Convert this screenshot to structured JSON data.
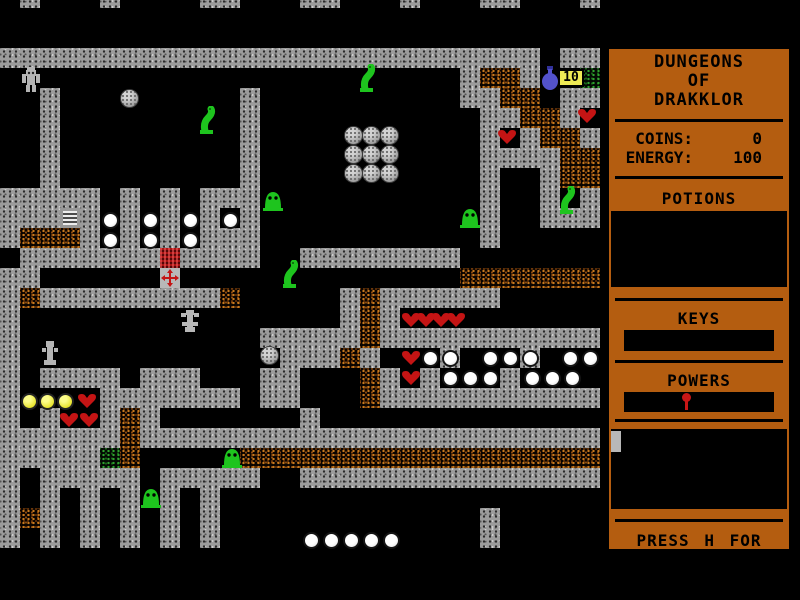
{
  "game": {
    "title_lines": [
      "DUNGEONS",
      "OF",
      "DRAKKLOR"
    ],
    "stats": [
      {
        "label": "COINS:",
        "value": "0"
      },
      {
        "label": "ENERGY:",
        "value": "100"
      }
    ],
    "sections": {
      "potions_label": "POTIONS",
      "keys_label": "KEYS",
      "powers_label": "POWERS"
    },
    "help_text": "PRESS H FOR HELP",
    "colors": {
      "panel_orange": "#b45d10",
      "wall_gray": "#9c9c9c",
      "rubble_orange": "#c87a1e",
      "moss_green": "#2fa32f",
      "heart_red": "#c41414",
      "creature_green": "#1ec41e",
      "flask_blue": "#5352cc",
      "badge_yellow": "#eeea55",
      "power_pin_red": "#c81616"
    }
  },
  "map": {
    "tile_size": 20,
    "offset_y": -12,
    "cols": 30,
    "rows": 31,
    "legend": {
      "#": "wall",
      ".": "floor",
      "r": "rubble",
      "g": "moss"
    },
    "grid": [
      ".#...#....##...##...#...##...#",
      "..............................",
      "..............................",
      "###########################.##",
      ".......................#rr#..g",
      "..#.........#..........##rr.##",
      "..#.........#...........##rr#.",
      "..#.........#...........#.#rr#",
      "..#.........#...........####rr",
      "..#.........#...........#..#rr",
      "#####.#.#.###...........#..#.#",
      "###.#.#.#.#.#...........#..###",
      "#rrr#.#.#.###...........#.....",
      ".#######.####..########.......",
      "##.....................rrrrrrr",
      "#r#########r.....#r######.....",
      "#................#r#..........",
      "#............#####r###########",
      "#.............###r#...#...#..",
      "#.####.###...##...r#.#...#....",
      "#....#######.##...r###########",
      "#.#..#r#.......#..............",
      "######r#######################",
      "#####gr.....rrrrrrrrrrrrrrrrrr",
      "#.#####.#####..###############",
      "#.#.#.#.#.#...................",
      "#r#.#.#.#.#.............#.....",
      "#.#.#.#.#.#.............#.....",
      "..............................",
      "..............................",
      ".............................."
    ],
    "sprites": [
      {
        "type": "golem",
        "col": 1.1,
        "row": 3.95
      },
      {
        "type": "worm",
        "col": 18,
        "row": 3.8
      },
      {
        "type": "worm",
        "col": 10,
        "row": 5.9
      },
      {
        "type": "boulder",
        "col": 6,
        "row": 5.05
      },
      {
        "type": "flask",
        "col": 27,
        "row": 3.9
      },
      {
        "type": "badge",
        "col": 27.9,
        "row": 4.05,
        "label": "10"
      },
      {
        "type": "heart",
        "col": 28.9,
        "row": 6.0
      },
      {
        "type": "heart",
        "col": 24.9,
        "row": 7.05
      },
      {
        "type": "boulder",
        "col": 17.2,
        "row": 6.9
      },
      {
        "type": "boulder",
        "col": 18.1,
        "row": 6.9
      },
      {
        "type": "boulder",
        "col": 19.0,
        "row": 6.9
      },
      {
        "type": "boulder",
        "col": 17.2,
        "row": 7.85
      },
      {
        "type": "boulder",
        "col": 18.1,
        "row": 7.85
      },
      {
        "type": "boulder",
        "col": 19.0,
        "row": 7.85
      },
      {
        "type": "boulder",
        "col": 17.2,
        "row": 8.8
      },
      {
        "type": "boulder",
        "col": 18.1,
        "row": 8.8
      },
      {
        "type": "boulder",
        "col": 19.0,
        "row": 8.8
      },
      {
        "type": "slug",
        "col": 13.15,
        "row": 9.95
      },
      {
        "type": "worm",
        "col": 28,
        "row": 9.9
      },
      {
        "type": "slug",
        "col": 23,
        "row": 10.8
      },
      {
        "type": "grate",
        "col": 3,
        "row": 11
      },
      {
        "type": "pearl",
        "col": 5.1,
        "row": 11.2
      },
      {
        "type": "pearl",
        "col": 7.1,
        "row": 11.2
      },
      {
        "type": "pearl",
        "col": 9.1,
        "row": 11.2
      },
      {
        "type": "pearl",
        "col": 11.1,
        "row": 11.2
      },
      {
        "type": "pearl",
        "col": 5.1,
        "row": 12.2
      },
      {
        "type": "pearl",
        "col": 7.1,
        "row": 12.2
      },
      {
        "type": "pearl",
        "col": 9.1,
        "row": 12.2
      },
      {
        "type": "chest_top",
        "col": 8,
        "row": 13
      },
      {
        "type": "chest_cross",
        "col": 8,
        "row": 14
      },
      {
        "type": "worm",
        "col": 14.15,
        "row": 13.6
      },
      {
        "type": "statue",
        "col": 9,
        "row": 16.1
      },
      {
        "type": "statue2",
        "col": 2,
        "row": 17.6
      },
      {
        "type": "boulder",
        "col": 13,
        "row": 17.9
      },
      {
        "type": "heart",
        "col": 20.1,
        "row": 16.2
      },
      {
        "type": "heart",
        "col": 20.85,
        "row": 16.2
      },
      {
        "type": "heart",
        "col": 21.6,
        "row": 16.2
      },
      {
        "type": "heart",
        "col": 22.35,
        "row": 16.2
      },
      {
        "type": "heart",
        "col": 20.1,
        "row": 18.1
      },
      {
        "type": "heart",
        "col": 20.1,
        "row": 19.1
      },
      {
        "type": "pearl",
        "col": 21.1,
        "row": 18.1
      },
      {
        "type": "pearl",
        "col": 22.1,
        "row": 18.1
      },
      {
        "type": "pearl",
        "col": 24.1,
        "row": 18.1
      },
      {
        "type": "pearl",
        "col": 25.1,
        "row": 18.1
      },
      {
        "type": "pearl",
        "col": 26.1,
        "row": 18.1
      },
      {
        "type": "pearl",
        "col": 28.1,
        "row": 18.1
      },
      {
        "type": "pearl",
        "col": 29.1,
        "row": 18.1
      },
      {
        "type": "pearl",
        "col": 22.1,
        "row": 19.1
      },
      {
        "type": "pearl",
        "col": 23.1,
        "row": 19.1
      },
      {
        "type": "pearl",
        "col": 24.1,
        "row": 19.1
      },
      {
        "type": "pearl",
        "col": 26.2,
        "row": 19.1
      },
      {
        "type": "pearl",
        "col": 27.2,
        "row": 19.1
      },
      {
        "type": "pearl",
        "col": 28.2,
        "row": 19.1
      },
      {
        "type": "yellow",
        "col": 1.05,
        "row": 20.25
      },
      {
        "type": "yellow",
        "col": 1.95,
        "row": 20.25
      },
      {
        "type": "yellow",
        "col": 2.85,
        "row": 20.25
      },
      {
        "type": "heart",
        "col": 3.9,
        "row": 20.25
      },
      {
        "type": "heart",
        "col": 3.0,
        "row": 21.2
      },
      {
        "type": "heart",
        "col": 4.0,
        "row": 21.2
      },
      {
        "type": "slug",
        "col": 11.1,
        "row": 22.8
      },
      {
        "type": "slug",
        "col": 7.05,
        "row": 24.8
      },
      {
        "type": "pearl",
        "col": 15.15,
        "row": 27.2
      },
      {
        "type": "pearl",
        "col": 16.15,
        "row": 27.2
      },
      {
        "type": "pearl",
        "col": 17.15,
        "row": 27.2
      },
      {
        "type": "pearl",
        "col": 18.15,
        "row": 27.2
      },
      {
        "type": "pearl",
        "col": 19.15,
        "row": 27.2
      }
    ]
  }
}
